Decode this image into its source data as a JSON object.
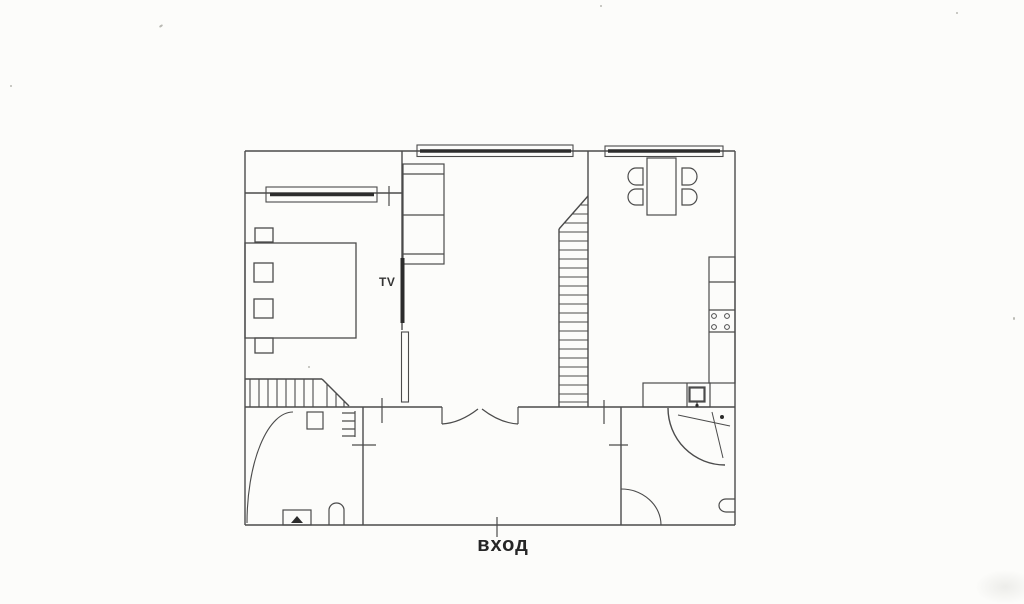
{
  "plan": {
    "labels": {
      "entrance": "вход",
      "tv": "TV"
    },
    "colors": {
      "background": "#fcfcfa",
      "wall_line": "#4b4b4b",
      "window_glass_line": "#2d2d2d",
      "text": "#262626"
    }
  }
}
